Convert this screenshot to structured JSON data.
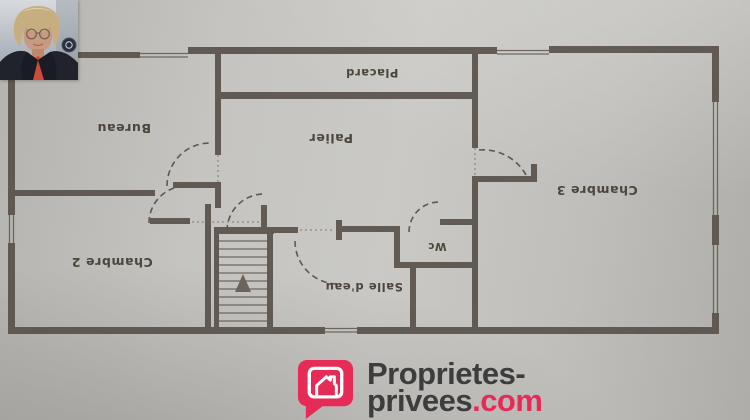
{
  "plan": {
    "labels": {
      "placard": "Placard",
      "palier": "Palier",
      "bureau": "Bureau",
      "chambre3": "Chambre 3",
      "chambre2": "Chambre 2",
      "salle_eau": "Salle d'eau",
      "wc": "Wc"
    }
  },
  "logo": {
    "line1": "Proprietes-",
    "line2_name": "privees",
    "line2_tld": ".com"
  },
  "colors": {
    "brand": "#e62b57",
    "wall": "#59524b",
    "wall-line": "#5f584f",
    "label-ink": "#4c463d",
    "ink-dark": "#3d3d3d"
  }
}
